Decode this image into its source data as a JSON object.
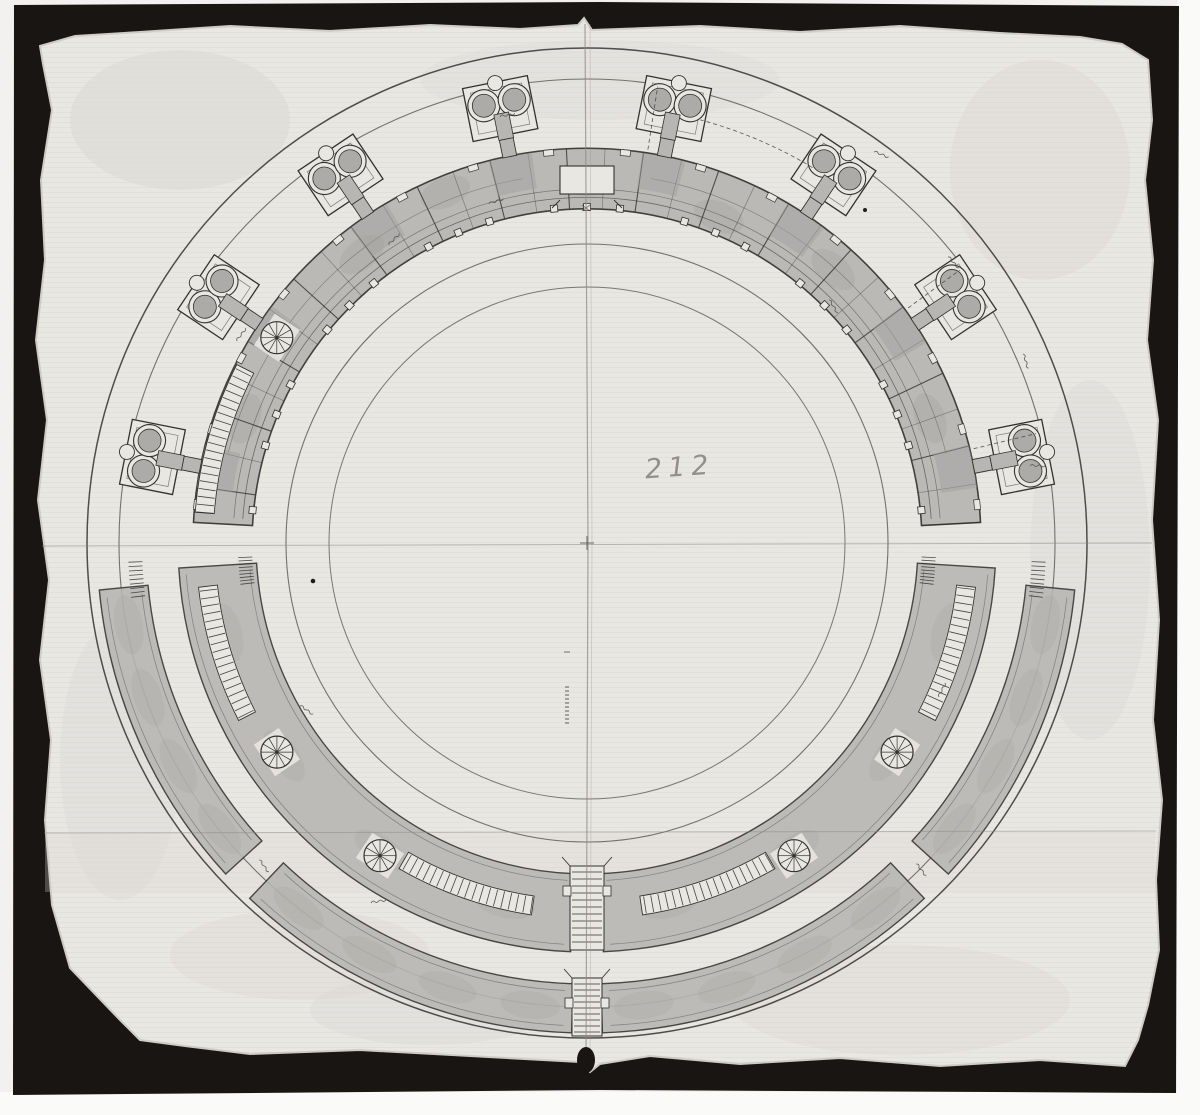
{
  "annotations": {
    "center_number": "212"
  },
  "colors": {
    "margin": "#f2f1ef",
    "margin_bright": "#fafaf8",
    "mat_black": "#181512",
    "paper": "#e9e7e2",
    "paper_edge": "#cfccc7",
    "paper_stain": "#dbd8d3",
    "wash": "#b7b6b3",
    "wash_dark": "#a2a09d",
    "ink": "#34322f",
    "ink_light": "#5f5d59",
    "pencil": "#807d78"
  },
  "plan": {
    "center": {
      "x": 587,
      "y": 543
    },
    "outer_circles_r": [
      500,
      468
    ],
    "inner_circles_r": [
      301,
      258
    ],
    "upper_wall": {
      "r_inner": 335,
      "r_outer": 394,
      "start_deg": 3,
      "end_deg": 177,
      "bay_step_deg": 5.625
    },
    "chapel_angles_deg": [
      11.25,
      33.75,
      56.25,
      78.75,
      101.25,
      123.75,
      146.25,
      168.75
    ],
    "spiral_stairs": [
      {
        "deg": 146.5,
        "r": 372
      },
      {
        "deg": 214,
        "r": 374
      },
      {
        "deg": 236.5,
        "r": 375
      },
      {
        "deg": 303.5,
        "r": 375
      },
      {
        "deg": 326,
        "r": 374
      }
    ],
    "arc_stairs": [
      {
        "r1": 374,
        "r2": 393,
        "a1": 153,
        "a2": 175.5
      },
      {
        "r1": 372,
        "r2": 391,
        "a1": 186.5,
        "a2": 207
      },
      {
        "r1": 357,
        "r2": 376,
        "a1": 240,
        "a2": 261.5
      },
      {
        "r1": 357,
        "r2": 376,
        "a1": 278.5,
        "a2": 300
      },
      {
        "r1": 372,
        "r2": 391,
        "a1": 333,
        "a2": 353.5
      }
    ],
    "lower_inner_band": {
      "r_inner": 331,
      "r_outer": 409,
      "segments": [
        [
          183.5,
          267.7
        ],
        [
          272.3,
          356.5
        ]
      ]
    },
    "lower_outer_band": {
      "r_inner": 441,
      "r_outer": 490,
      "segments": [
        [
          185.5,
          222.5
        ],
        [
          226.5,
          268.2
        ],
        [
          271.8,
          313.5
        ],
        [
          317.5,
          354.5
        ]
      ]
    }
  }
}
